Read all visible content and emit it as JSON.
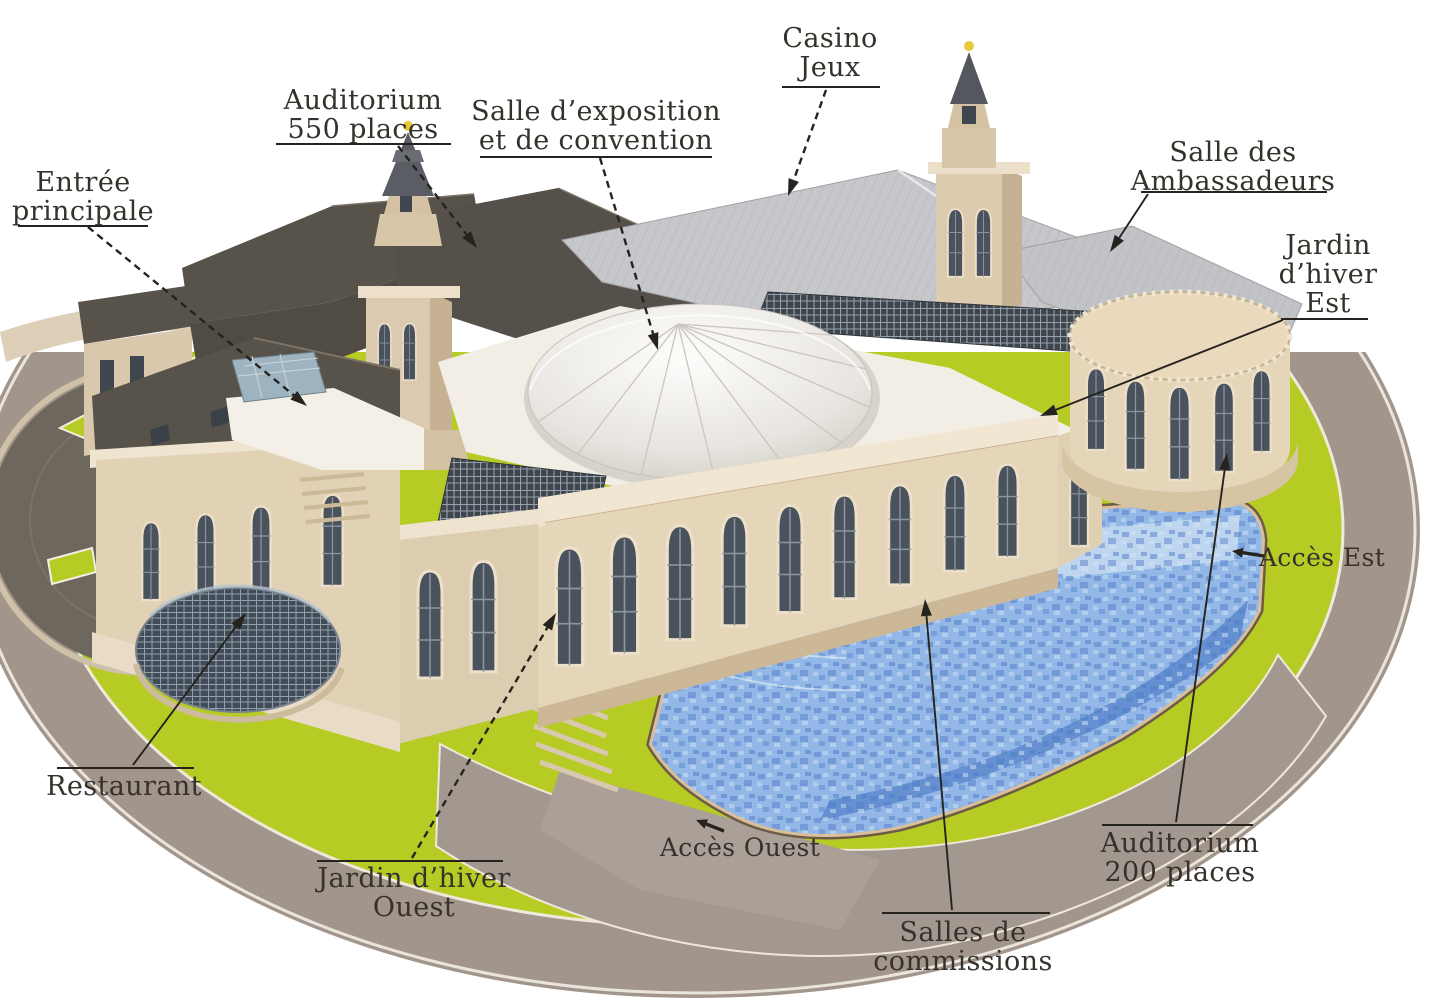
{
  "colors": {
    "text": "#35312b",
    "line": "#26231f",
    "lawn": "#b6cb24",
    "road": "#a2958c",
    "plaza": "#a39890",
    "stone_light": "#e5d6ba",
    "stone_shadow": "#c6b193",
    "roof_dark": "#57524a",
    "roof_metal": "#c6c7ca",
    "dome": "#f0ede7",
    "water": "#93b7e6",
    "water_deep": "#517fc7",
    "pool_edge": "#d9bf9b",
    "glass": "#41505e",
    "gold": "#e7c838",
    "dark_circle": "#6e675e"
  },
  "labels": [
    {
      "id": "casino",
      "lines": [
        "Casino",
        "Jeux"
      ],
      "x": 830,
      "y": 24,
      "rule": {
        "type": "under",
        "x1": 782,
        "x2": 880,
        "y": 86
      },
      "leader": {
        "x1": 826,
        "y1": 90,
        "x2": 788,
        "y2": 196,
        "dashed": true,
        "arrow": true
      }
    },
    {
      "id": "auditorium-550",
      "lines": [
        "Auditorium",
        "550 places"
      ],
      "x": 363,
      "y": 86,
      "rule": {
        "type": "under",
        "x1": 276,
        "x2": 451,
        "y": 143
      },
      "leader": {
        "x1": 398,
        "y1": 146,
        "x2": 477,
        "y2": 248,
        "dashed": true,
        "arrow": true
      }
    },
    {
      "id": "salle-exposition",
      "lines": [
        "Salle d’exposition",
        "et de convention"
      ],
      "x": 596,
      "y": 97,
      "rule": {
        "type": "under",
        "x1": 480,
        "x2": 712,
        "y": 156
      },
      "leader": {
        "x1": 600,
        "y1": 158,
        "x2": 658,
        "y2": 350,
        "dashed": true,
        "arrow": true
      }
    },
    {
      "id": "salle-ambassadeurs",
      "lines": [
        "Salle des",
        "Ambassadeurs"
      ],
      "x": 1233,
      "y": 138,
      "rule": {
        "type": "under",
        "x1": 1141,
        "x2": 1327,
        "y": 191
      },
      "leader": {
        "x1": 1148,
        "y1": 194,
        "x2": 1110,
        "y2": 252,
        "dashed": false,
        "arrow": true
      }
    },
    {
      "id": "jardin-hiver-est",
      "lines": [
        "Jardin",
        "d’hiver",
        "Est"
      ],
      "x": 1328,
      "y": 231,
      "rule": {
        "type": "under",
        "x1": 1281,
        "x2": 1368,
        "y": 318
      },
      "leader": {
        "x1": 1283,
        "y1": 320,
        "x2": 1040,
        "y2": 416,
        "dashed": false,
        "arrow": true
      }
    },
    {
      "id": "entree-principale",
      "lines": [
        "Entrée",
        "principale"
      ],
      "x": 83,
      "y": 168,
      "rule": {
        "type": "under",
        "x1": 18,
        "x2": 148,
        "y": 225
      },
      "leader": {
        "x1": 88,
        "y1": 227,
        "x2": 307,
        "y2": 406,
        "dashed": true,
        "arrow": true
      }
    },
    {
      "id": "acces-est",
      "lines": [
        "Accès Est"
      ],
      "x": 1322,
      "y": 543,
      "size": 25,
      "glyph": {
        "x1": 1264,
        "y1": 556,
        "x2": 1232,
        "y2": 551
      }
    },
    {
      "id": "restaurant",
      "lines": [
        "Restaurant"
      ],
      "x": 124,
      "y": 772,
      "rule": {
        "type": "over",
        "x1": 57,
        "x2": 194,
        "y": 767
      },
      "leader": {
        "x1": 133,
        "y1": 765,
        "x2": 246,
        "y2": 613,
        "dashed": false,
        "arrow": true
      }
    },
    {
      "id": "jardin-hiver-ouest",
      "lines": [
        "Jardin d’hiver",
        "Ouest"
      ],
      "x": 414,
      "y": 864,
      "rule": {
        "type": "over",
        "x1": 317,
        "x2": 503,
        "y": 860
      },
      "leader": {
        "x1": 412,
        "y1": 858,
        "x2": 556,
        "y2": 613,
        "dashed": true,
        "arrow": true
      }
    },
    {
      "id": "acces-ouest",
      "lines": [
        "Accès Ouest"
      ],
      "x": 740,
      "y": 833,
      "size": 25,
      "glyph": {
        "x1": 724,
        "y1": 831,
        "x2": 696,
        "y2": 820
      }
    },
    {
      "id": "salles-commissions",
      "lines": [
        "Salles de",
        "commissions"
      ],
      "x": 963,
      "y": 918,
      "rule": {
        "type": "over",
        "x1": 882,
        "x2": 1050,
        "y": 912
      },
      "leader": {
        "x1": 952,
        "y1": 910,
        "x2": 925,
        "y2": 599,
        "dashed": false,
        "arrow": true
      }
    },
    {
      "id": "auditorium-200",
      "lines": [
        "Auditorium",
        "200 places"
      ],
      "x": 1180,
      "y": 829,
      "rule": {
        "type": "over",
        "x1": 1102,
        "x2": 1253,
        "y": 824
      },
      "leader": {
        "x1": 1176,
        "y1": 822,
        "x2": 1227,
        "y2": 453,
        "dashed": false,
        "arrow": true
      }
    }
  ]
}
